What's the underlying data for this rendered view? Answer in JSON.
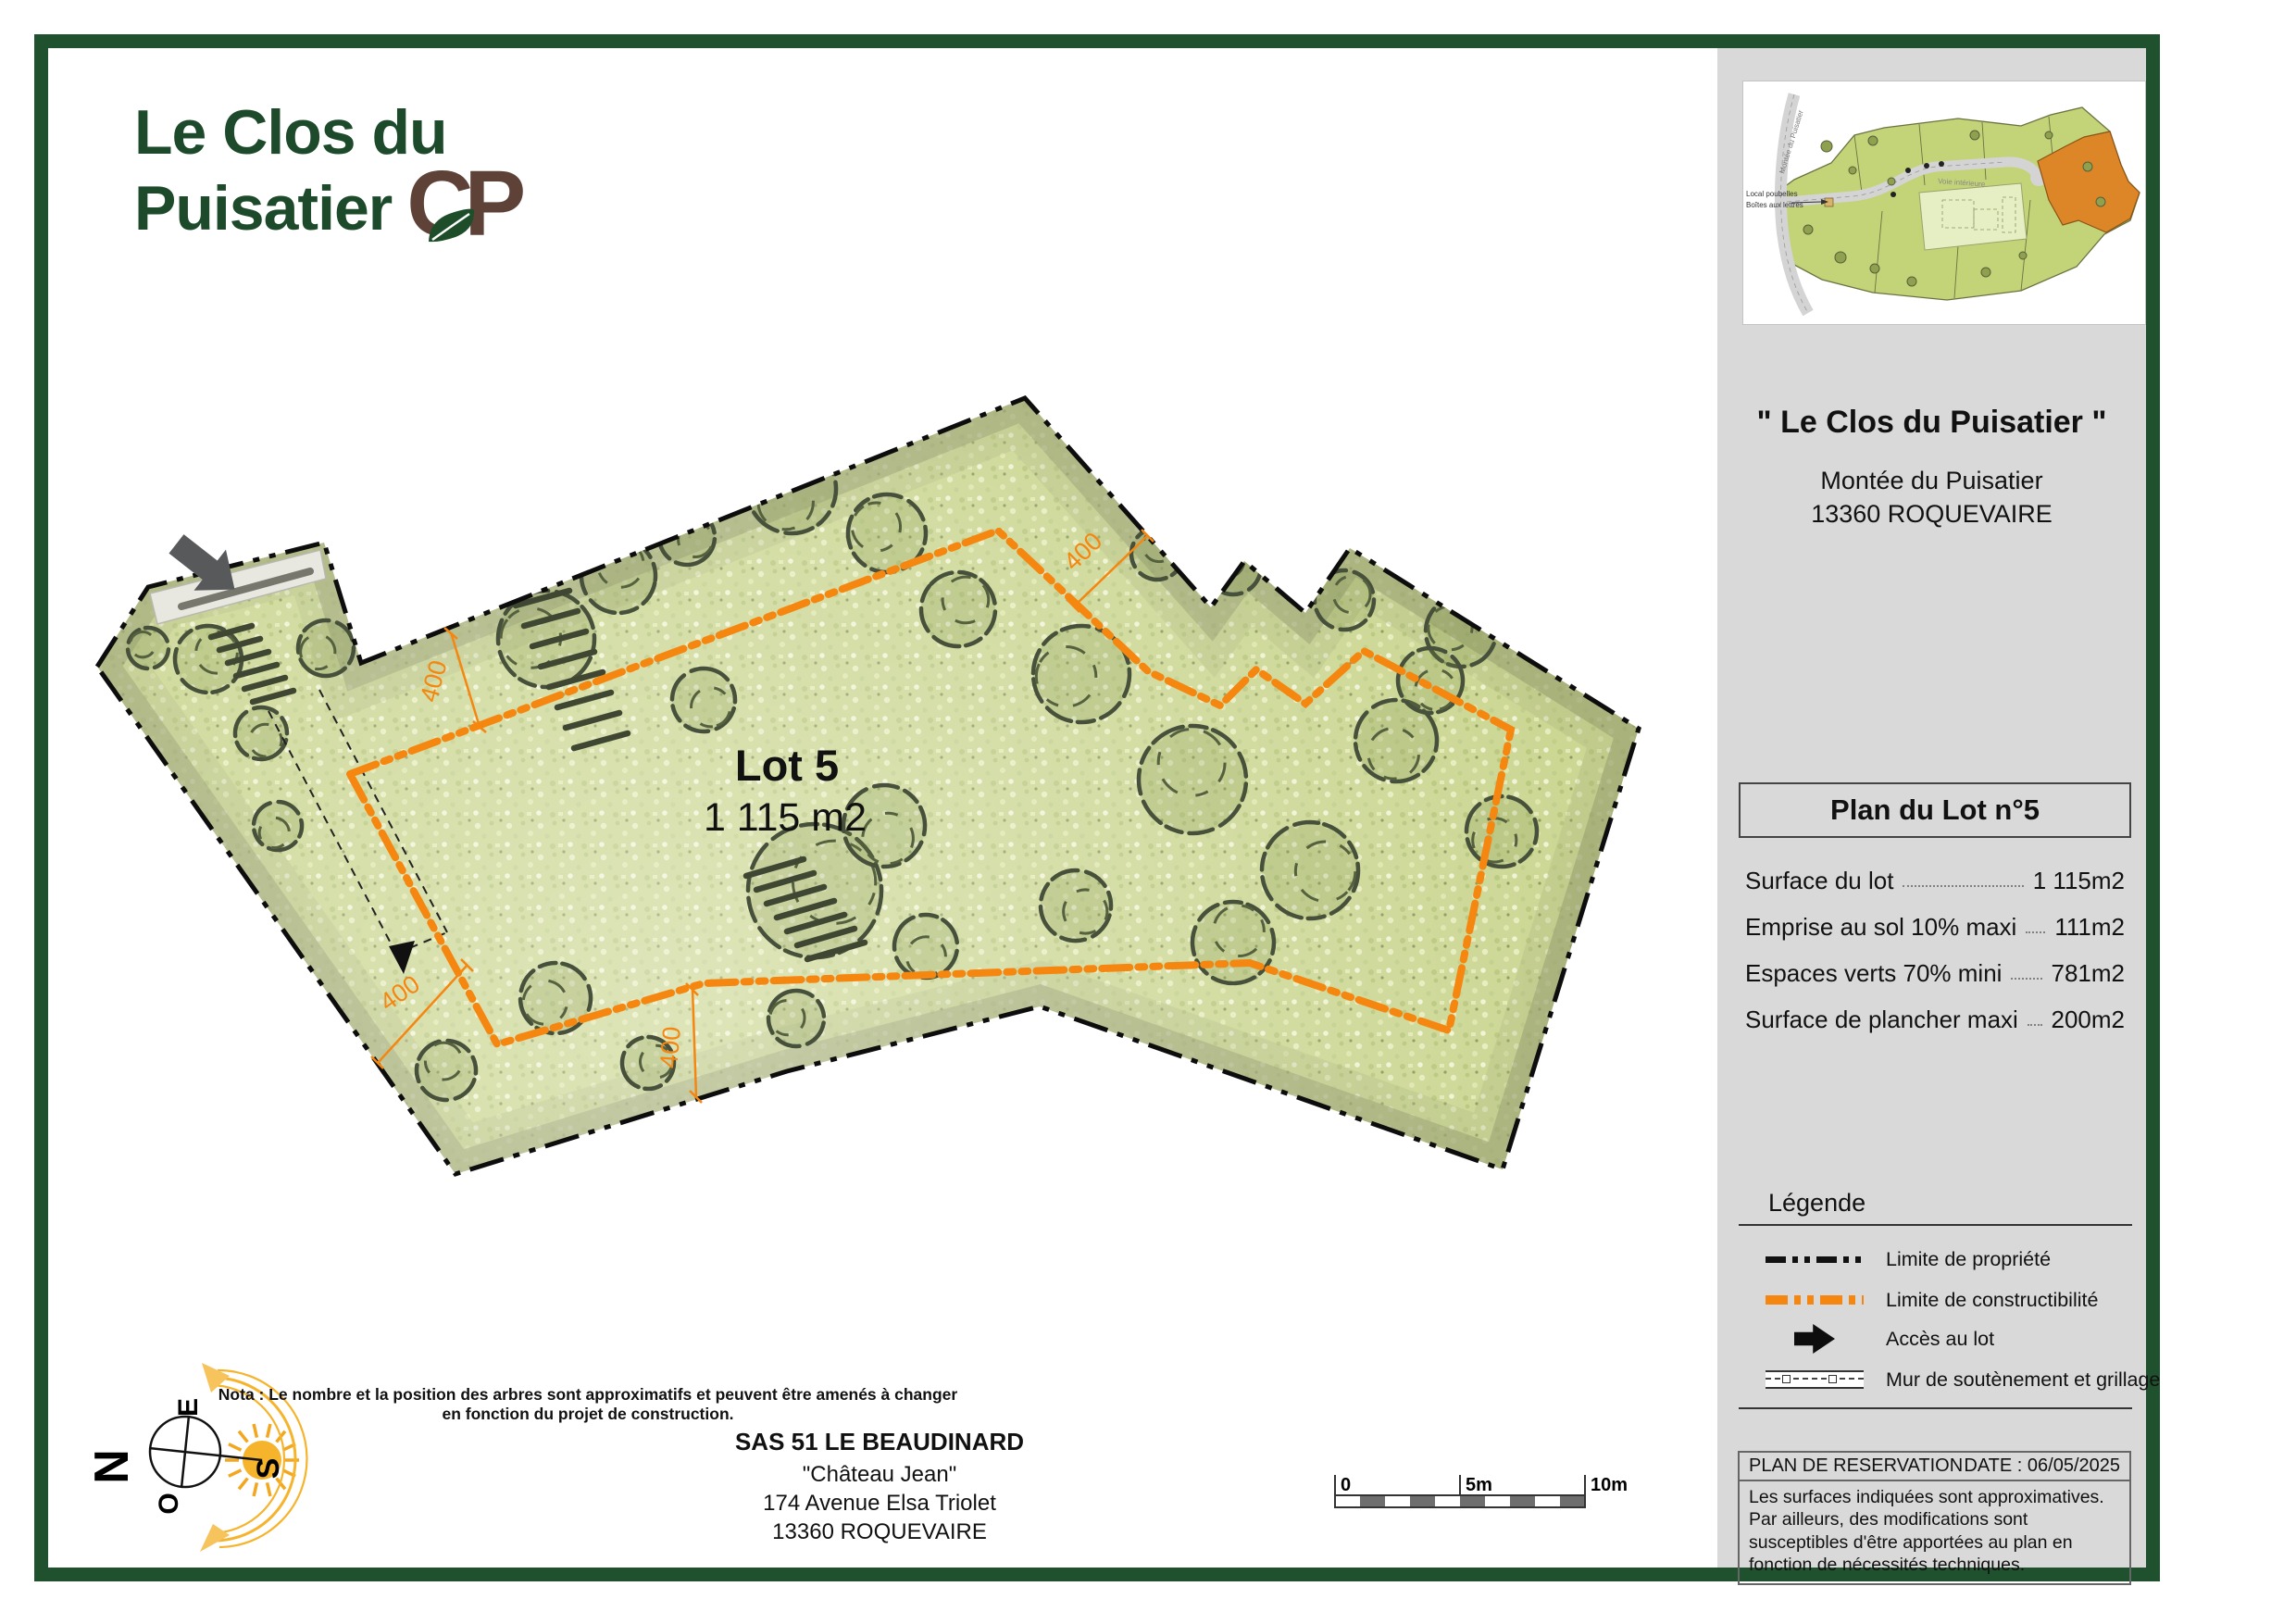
{
  "logo": {
    "line1": "Le Clos du",
    "line2": "Puisatier",
    "monogram": "CP"
  },
  "plan": {
    "lot_label": "Lot 5",
    "lot_area": "1 115 m2",
    "dim_a": "400",
    "dim_b": "400",
    "dim_c": "400",
    "dim_d": "400"
  },
  "footer": {
    "nota": "Nota : Le nombre et la position des arbres sont approximatifs et peuvent être amenés à changer en fonction du projet de construction.",
    "developer": {
      "name": "SAS 51 LE BEAUDINARD",
      "line2": "\"Château Jean\"",
      "line3": "174 Avenue Elsa Triolet",
      "line4": "13360 ROQUEVAIRE"
    }
  },
  "scalebar": {
    "t0": "0",
    "t5": "5m",
    "t10": "10m"
  },
  "compass": {
    "n": "N",
    "e": "E",
    "s": "S",
    "o": "O"
  },
  "sidebar": {
    "title": "\" Le Clos du Puisatier \"",
    "address1": "Montée du Puisatier",
    "address2": "13360 ROQUEVAIRE",
    "plan_box_title": "Plan du Lot n°5",
    "table": [
      {
        "label": "Surface du lot",
        "value": "1 115m2"
      },
      {
        "label": "Emprise au sol 10% maxi",
        "value": "111m2"
      },
      {
        "label": "Espaces verts 70% mini",
        "value": "781m2"
      },
      {
        "label": "Surface de plancher maxi",
        "value": "200m2"
      }
    ],
    "legend": {
      "title": "Légende",
      "items": [
        "Limite de propriété",
        "Limite de constructibilité",
        "Accès au lot",
        "Mur de soutènement et grillage"
      ]
    },
    "reservation": {
      "title": "PLAN DE RESERVATION",
      "date": "DATE : 06/05/2025",
      "body": "Les surfaces indiquées sont approximatives. Par ailleurs, des modifications sont susceptibles d'être apportées au plan en fonction de nécessités techniques."
    },
    "minimap": {
      "road": "Montée du Puisatier",
      "inner": "Voie intérieure",
      "bins": "Local poubelles",
      "mail": "Boîtes aux lettres"
    }
  },
  "colors": {
    "frame_green": "#20512F",
    "logo_green": "#1D4A2B",
    "monogram_brown": "#5E4238",
    "accent_orange": "#F5860F",
    "sidebar_gray": "#D9D9D9",
    "lot_highlight": "#DD8628",
    "terrain_green": "#CCD794"
  }
}
